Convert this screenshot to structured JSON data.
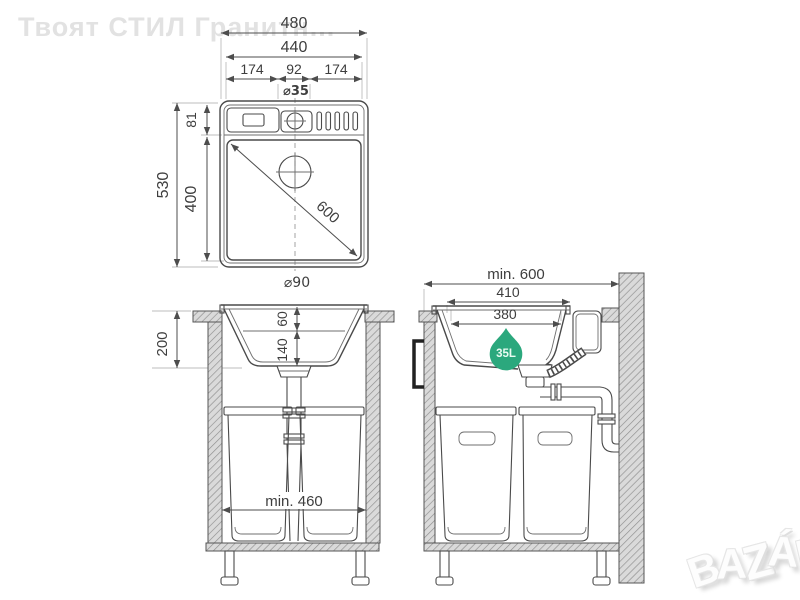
{
  "watermarks": {
    "brand_top_left": "Твоят СТИЛ Гранитн...",
    "bazar_letters": [
      "B",
      "A",
      "Z",
      "Á",
      "R"
    ]
  },
  "colors": {
    "background": "#ffffff",
    "line": "#4a4a4a",
    "hatch_fill": "#dadada",
    "watermark_gray": "#e2e2e2",
    "badge_green": "#2ba87d",
    "badge_text": "#eafbf2"
  },
  "top_view": {
    "dim_480": "480",
    "dim_440": "440",
    "dim_174_left": "174",
    "dim_92": "92",
    "dim_174_right": "174",
    "dim_tap_hole": "⌀35",
    "dim_530": "530",
    "dim_81": "81",
    "dim_400": "400",
    "dim_600_diagonal": "600",
    "dim_drain": "⌀90"
  },
  "front_view": {
    "dim_200": "200",
    "dim_60": "60",
    "dim_140": "140",
    "dim_min_460": "min. 460"
  },
  "side_view": {
    "dim_min_600": "min. 600",
    "dim_410": "410",
    "dim_380": "380",
    "badge_capacity": "35L"
  }
}
